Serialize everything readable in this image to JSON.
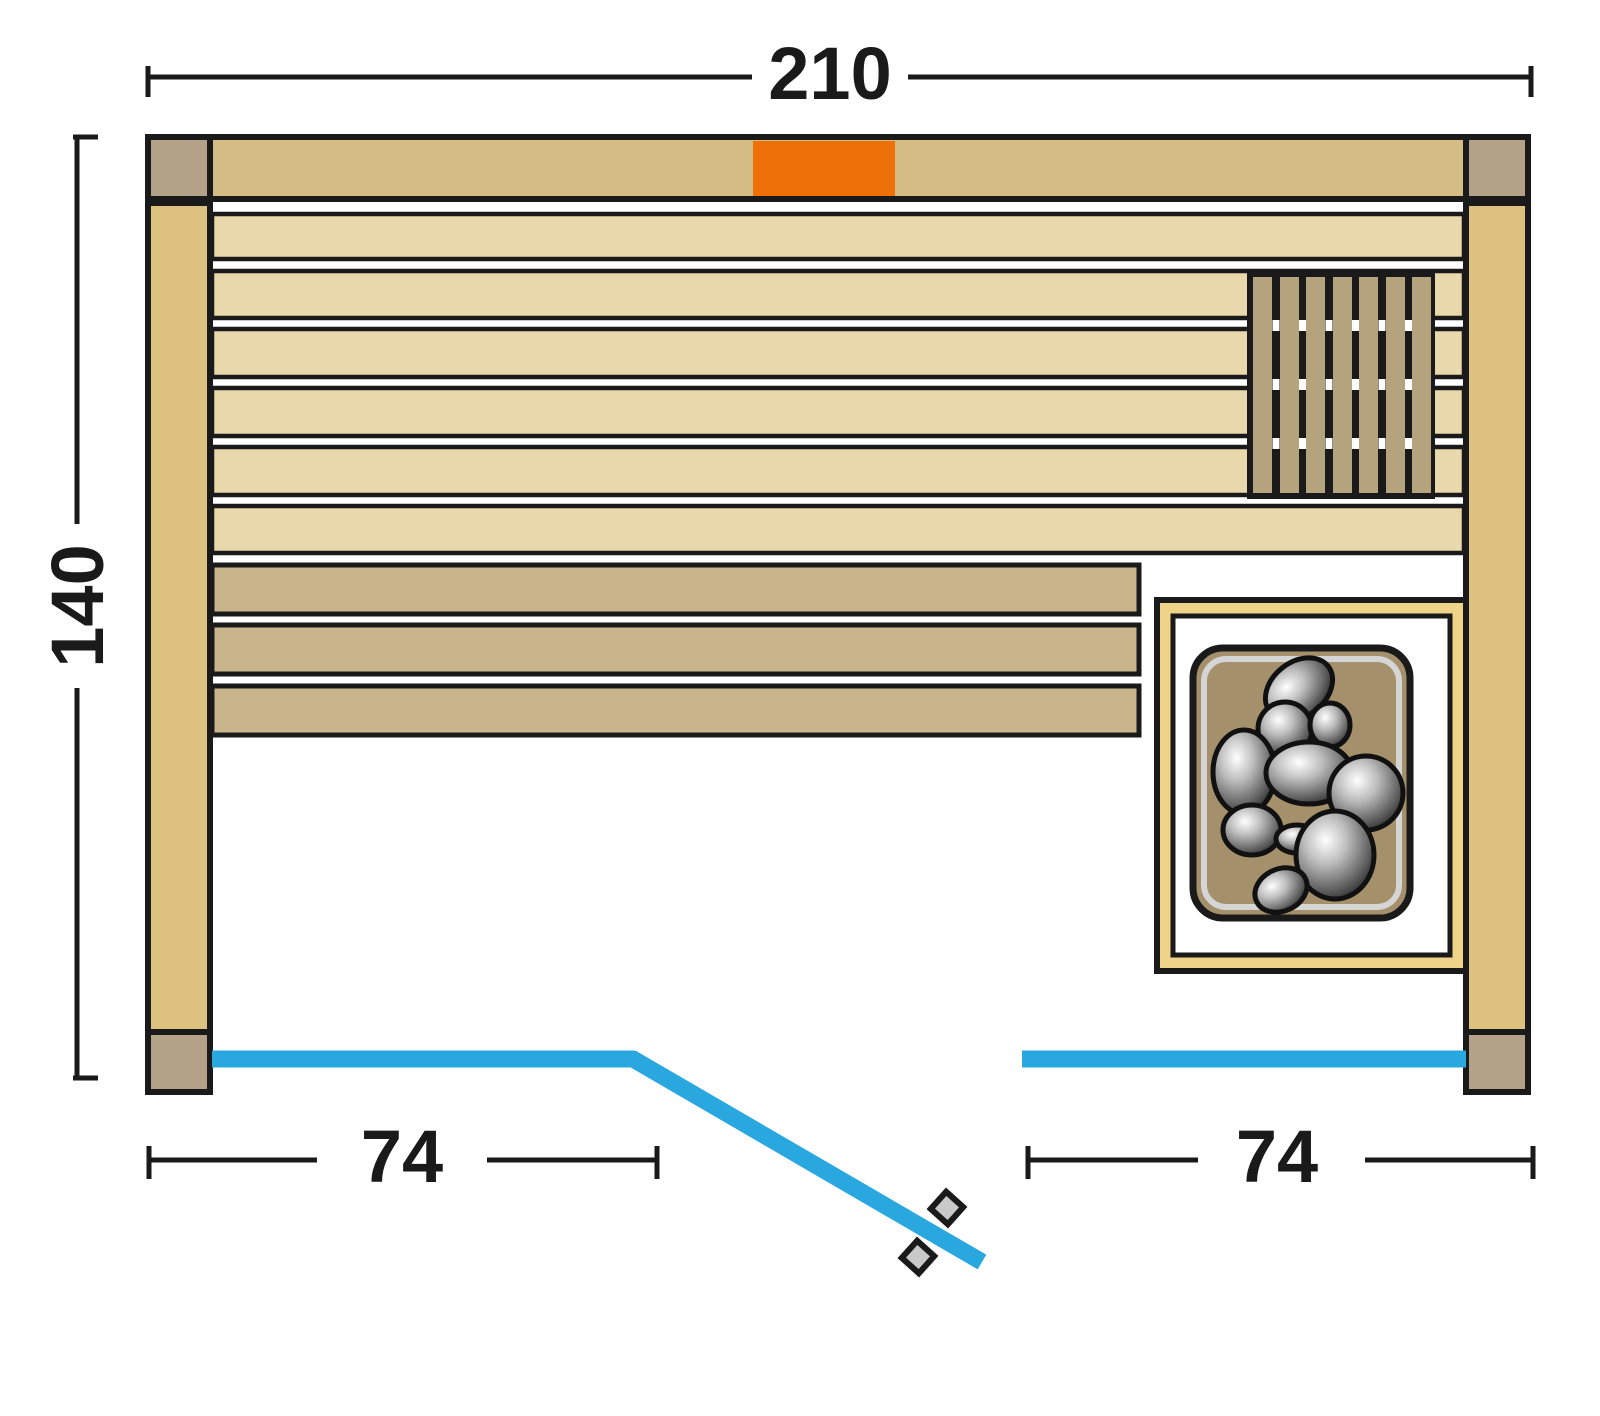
{
  "dimensions": {
    "total_width": "210",
    "total_height": "140",
    "front_left_section": "74",
    "front_right_section": "74"
  },
  "colors": {
    "outline": "#1a1a1a",
    "wood_wall": "#d3bd85",
    "wood_corner": "#b3a287",
    "wood_post": "#dcc17f",
    "wood_plank": "#e9d8ab",
    "wood_bench": "#c9b58c",
    "wood_slat": "#b5a37e",
    "heater_frame": "#eed389",
    "heater_body": "#a4906a",
    "glass_blue": "#29a8e0",
    "light_orange": "#ee7107",
    "handle_gray": "#c9c9c9"
  }
}
